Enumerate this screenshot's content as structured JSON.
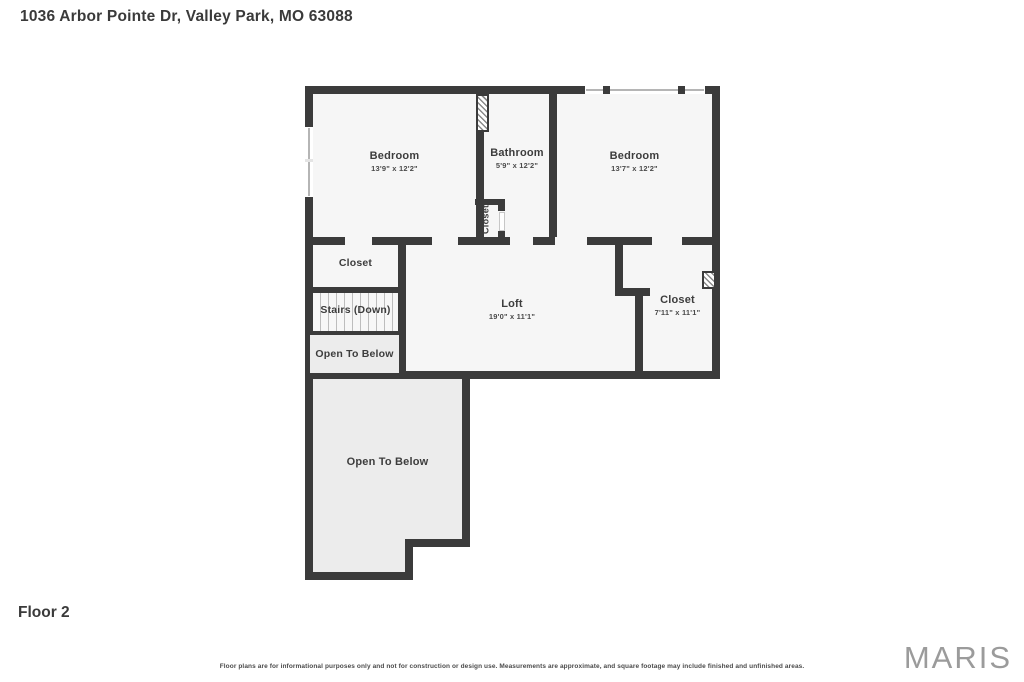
{
  "header": {
    "address": "1036 Arbor Pointe Dr, Valley Park, MO 63088"
  },
  "floor": {
    "label": "Floor 2"
  },
  "rooms": {
    "bedroom_left": {
      "name": "Bedroom",
      "dims": "13'9\" x 12'2\""
    },
    "bathroom": {
      "name": "Bathroom",
      "dims": "5'9\" x 12'2\""
    },
    "bedroom_right": {
      "name": "Bedroom",
      "dims": "13'7\" x 12'2\""
    },
    "bathroom_closet": {
      "name": "Closet"
    },
    "hall_closet": {
      "name": "Closet"
    },
    "stairs": {
      "name": "Stairs (Down)"
    },
    "open_to_below_upper": {
      "name": "Open To Below"
    },
    "loft": {
      "name": "Loft",
      "dims": "19'0\" x 11'1\""
    },
    "walkin_closet": {
      "name": "Closet",
      "dims": "7'11\" x 11'1\""
    },
    "open_to_below_lower": {
      "name": "Open To Below"
    }
  },
  "footer": {
    "disclaimer": "Floor plans are for informational purposes only and not for construction or design use. Measurements are approximate, and square footage may include finished and unfinished areas.",
    "logo": "MARIS"
  },
  "colors": {
    "wall": "#3b3b3b",
    "room_fill": "#f6f6f6",
    "open_area_fill": "#ececec",
    "logo_gray": "#9b9b9b"
  }
}
